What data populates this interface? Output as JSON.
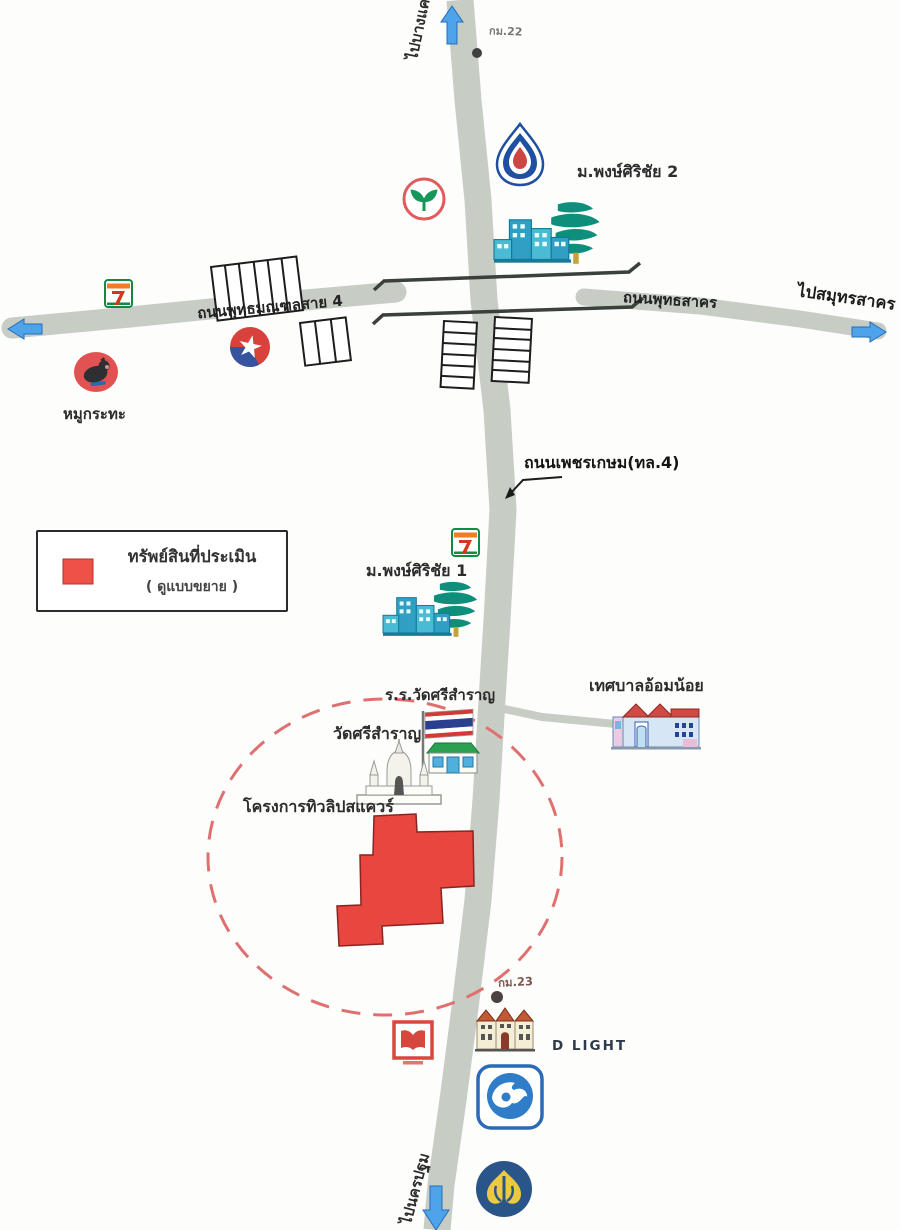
{
  "legend": {
    "title": "ทรัพย์สินที่ประเมิน",
    "subtitle": "( ดูแบบขยาย )"
  },
  "roads": {
    "phetkasem_label": "ถนนเพชรเกษม(ทล.4)",
    "sai4_label": "ถนนพุทธมณฑลสาย 4",
    "sakhon_label": "ถนนพุทธสาคร"
  },
  "directions": {
    "north": "ไปบางแค",
    "south": "ไปนครปฐม",
    "east": "ไปสมุทรสาคร"
  },
  "places": {
    "village2": "ม.พงษ์ศิริชัย 2",
    "village1": "ม.พงษ์ศิริชัย 1",
    "pork_bbq": "หมูกระทะ",
    "school": "ร.ร.วัดศรีสำราญ",
    "temple": "วัดศรีสำราญ",
    "municipality": "เทศบาลอ้อมน้อย",
    "project": "โครงการทิวลิปสแควร์",
    "dlight": "D LIGHT"
  },
  "markers": {
    "km22": "กม.22",
    "km23": "กม.23"
  },
  "icons": {
    "ptt": "ptt-gas-station-logo",
    "kasikorn": "kasikorn-bank-logo",
    "seven_eleven": "seven-eleven-logo",
    "caltex": "caltex-logo",
    "pork": "pork-bbq-restaurant-icon",
    "village": "housing-estate-buildings-icon",
    "school": "thai-flag-school-icon",
    "temple": "temple-stupa-icon",
    "municipality": "municipality-building-icon",
    "dlight": "townhouse-row-icon",
    "krungthai": "krungthai-bank-logo",
    "bangkok_bank": "bangkok-bank-logo",
    "red_m": "red-m-store-logo",
    "bridge": "overpass-bridge",
    "shophouses": "shophouse-row",
    "km_dot": "kilometer-marker-dot",
    "arrow": "direction-arrow"
  },
  "colors": {
    "road": "#c7cdc5",
    "property_fill": "#e8463f",
    "property_stroke": "#8a2420",
    "dashed_circle": "#e07070",
    "arrow_blue": "#4fa3e8",
    "legend_swatch": "#ef5048"
  }
}
